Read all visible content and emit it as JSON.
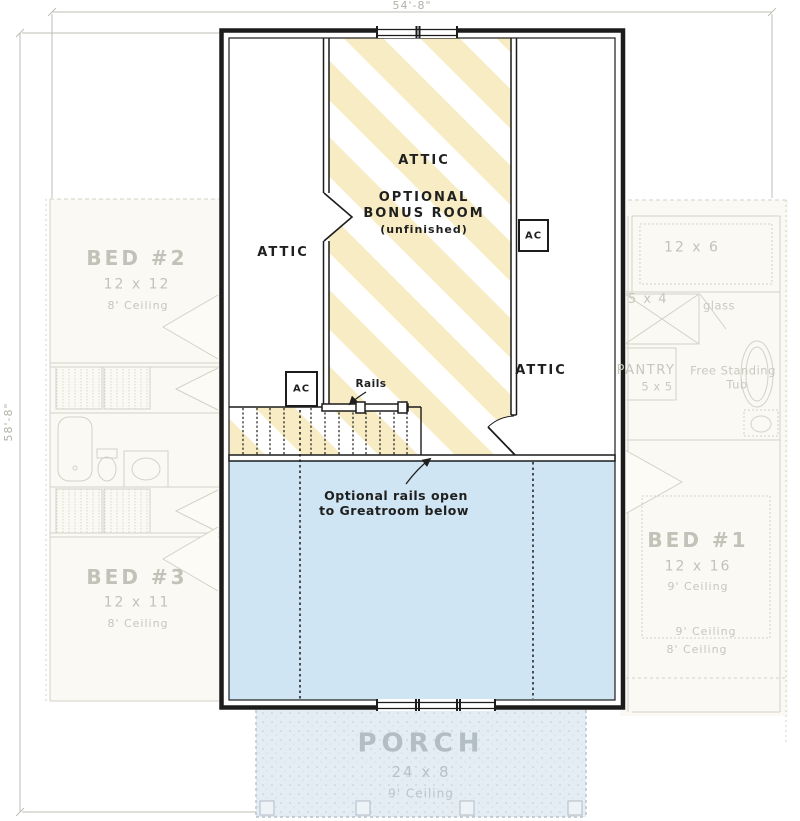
{
  "dimensions": {
    "width": "54'-8\"",
    "height": "58'-8\""
  },
  "upper_floor": {
    "attic_left": "ATTIC",
    "attic_center": "ATTIC",
    "attic_right": "ATTIC",
    "bonus_line1": "OPTIONAL",
    "bonus_line2": "BONUS ROOM",
    "bonus_line3": "(unfinished)",
    "ac_left": "AC",
    "ac_right": "AC",
    "rails": "Rails",
    "note_line1": "Optional rails open",
    "note_line2": "to Greatroom below"
  },
  "first_floor": {
    "bed2": {
      "name": "BED #2",
      "size": "12 x 12",
      "ceiling": "8' Ceiling"
    },
    "bed3": {
      "name": "BED #3",
      "size": "12 x 11",
      "ceiling": "8' Ceiling"
    },
    "bed1": {
      "name": "BED #1",
      "size": "12 x 16",
      "ceiling": "9' Ceiling",
      "ceiling_break_9": "9' Ceiling",
      "ceiling_break_8": "8' Ceiling"
    },
    "closet_top": "12 x 6",
    "shower": "5 x 4",
    "glass": "glass",
    "pantry_name": "PANTRY",
    "pantry_size": "5 x 5",
    "tub_line1": "Free Standing",
    "tub_line2": "Tub",
    "porch": {
      "name": "PORCH",
      "size": "24 x 8",
      "ceiling": "9' Ceiling"
    }
  },
  "colors": {
    "wall": "#1c1c1c",
    "bonus_stripe": "#f7ecc3",
    "open_below": "#cfe5f3",
    "porch_fill": "#e4edf4",
    "faded_line": "#d0d0c6",
    "faded_text": "#c2c2b8",
    "dimension": "#b7b7af"
  }
}
